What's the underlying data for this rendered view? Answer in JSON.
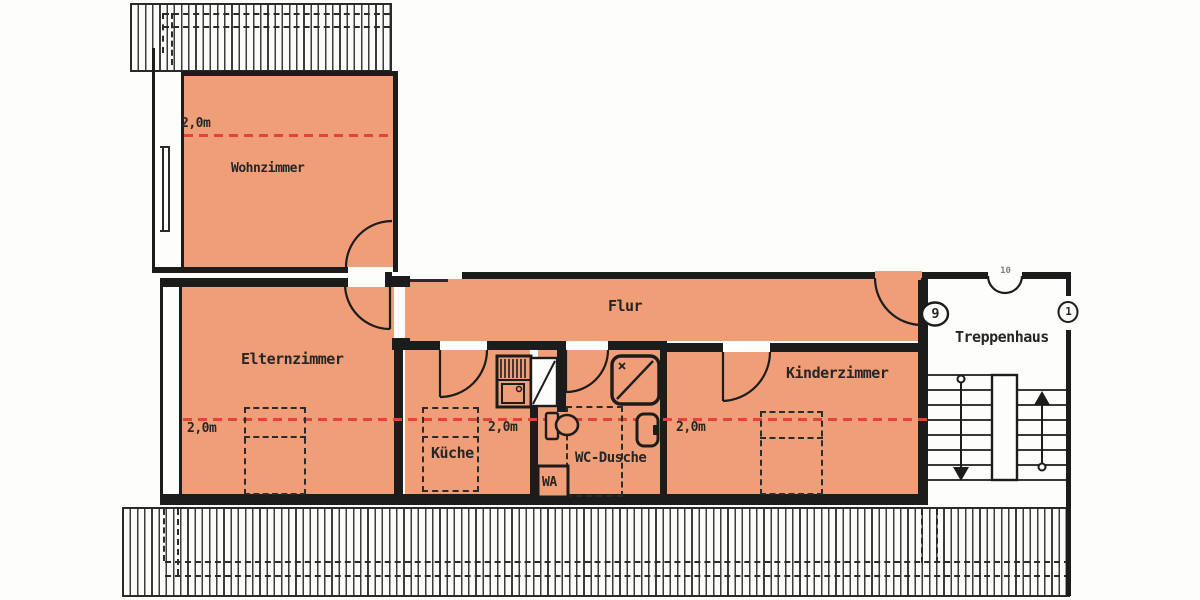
{
  "rooms": {
    "wohnzimmer": {
      "label": "Wohnzimmer"
    },
    "elternzimmer": {
      "label": "Elternzimmer"
    },
    "flur": {
      "label": "Flur"
    },
    "kueche": {
      "label": "Küche"
    },
    "wc_dusche": {
      "label": "WC-Dusche"
    },
    "kinderzimmer": {
      "label": "Kinderzimmer"
    },
    "treppenhaus": {
      "label": "Treppenhaus"
    }
  },
  "annotations": {
    "height_line_label": "2,0m",
    "washing_machine_label": "WA",
    "door_number_9": "9",
    "door_number_10": "10",
    "door_number_1": "1"
  },
  "colors": {
    "room_fill": "#ef9e78",
    "height_line": "#e0453a",
    "wall": "#1c1c1c"
  }
}
